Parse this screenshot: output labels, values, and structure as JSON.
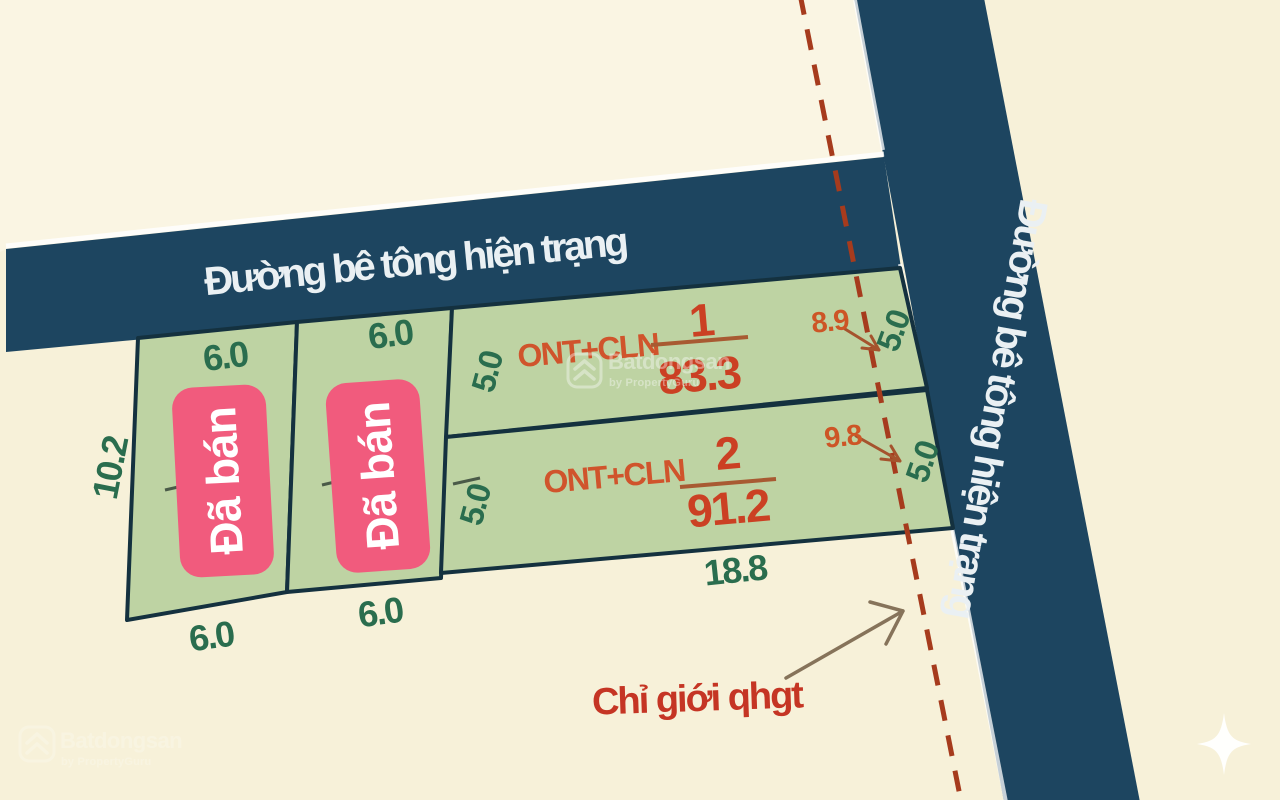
{
  "roads": {
    "top_label": "Đường bê tông hiện trạng",
    "right_label": "Đường bê tông hiện trạng"
  },
  "boundary": {
    "label": "Chỉ giới qhgt"
  },
  "plots": {
    "sold_left": {
      "status": "Đã bán",
      "width_top": "6.0",
      "width_bottom": "6.0",
      "depth": "10.2"
    },
    "sold_right": {
      "status": "Đã bán",
      "width_top": "6.0",
      "width_bottom": "6.0"
    },
    "lot1": {
      "use": "ONT+CLN",
      "number": "1",
      "area": "83.3",
      "depth_left": "5.0",
      "depth_right": "5.0",
      "offset": "8.9"
    },
    "lot2": {
      "use": "ONT+CLN",
      "number": "2",
      "area": "91.2",
      "depth_left": "5.0",
      "depth_right": "5.0",
      "offset": "9.8",
      "width_bottom": "18.8"
    }
  },
  "watermark": {
    "brand": "Batdongsan",
    "byline": "by PropertyGuru"
  },
  "colors": {
    "background": "#f7f1d9",
    "road": "#1d4560",
    "plot_fill": "#bed3a3",
    "plot_outline": "#14313f",
    "sold_badge": "#f15b7d",
    "dimension_text": "#2a6d4e",
    "land_use_text": "#d0542c",
    "area_text": "#cb4023",
    "boundary_line": "#a63b1d",
    "road_text": "#eaf0f3"
  }
}
